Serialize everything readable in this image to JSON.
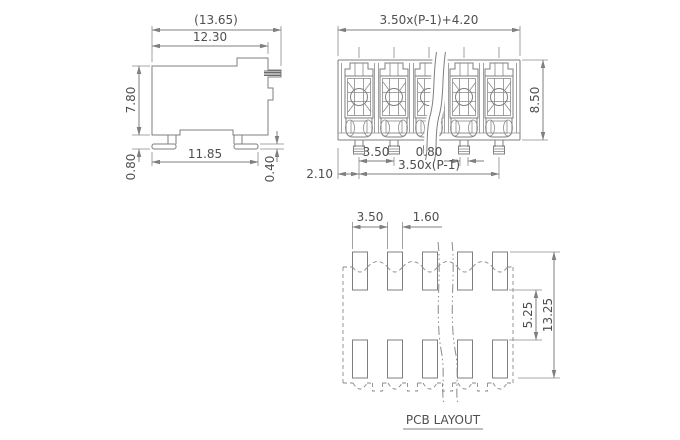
{
  "drawing": {
    "background": "#ffffff",
    "line_color": "#7f7f7f",
    "text_color": "#4f4f4f",
    "side_view": {
      "dim_overall_width": "(13.65)",
      "dim_body_width": "12.30",
      "dim_body_height": "7.80",
      "dim_standoff": "0.80",
      "dim_foot_span": "11.85",
      "dim_foot_thickness": "0.40"
    },
    "front_view": {
      "dim_overall_width": "3.50x(P-1)+4.20",
      "dim_body_height": "8.50",
      "dim_pin_pitch": "3.50",
      "dim_pin_width": "0.80",
      "dim_end_margin": "2.10",
      "dim_pin_span": "3.50x(P-1)"
    },
    "pcb_layout": {
      "title": "PCB LAYOUT",
      "dim_pad_pitch": "3.50",
      "dim_pad_width": "1.60",
      "dim_row_gap": "5.25",
      "dim_total_height": "13.25"
    }
  }
}
